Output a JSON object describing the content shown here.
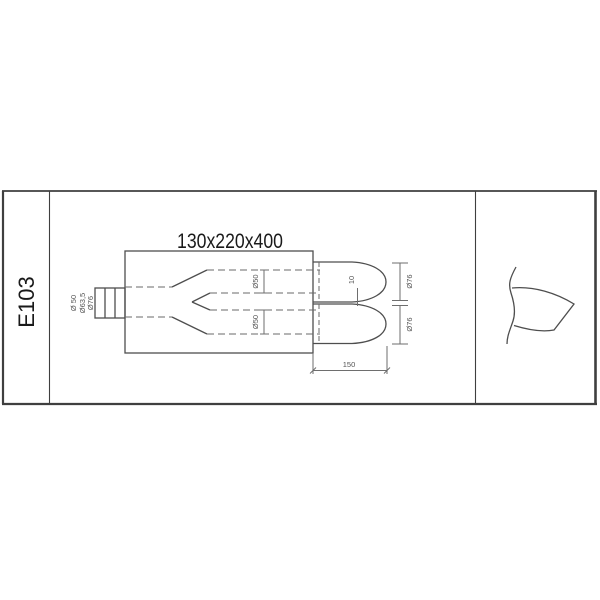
{
  "sheet": {
    "part_code": "E103",
    "dimensions_title": "130x220x400"
  },
  "labels": {
    "inlet_d_inner": "Ø 50",
    "inlet_d_mid": "Ø63,5",
    "inlet_d_outer": "Ø76",
    "branch_top_d": "Ø50",
    "branch_bottom_d": "Ø50",
    "tip_top_d": "Ø76",
    "tip_bottom_d": "Ø76",
    "tip_gap": "10",
    "tip_length": "150"
  },
  "colors": {
    "background": "#ffffff",
    "frame": "#3f3f3f",
    "outline": "#4e4e4e",
    "hidden_line": "#6a6a6a",
    "dimension": "#6e6e6e",
    "text_primary": "#1a1a1a",
    "text_dimension": "#555555"
  }
}
